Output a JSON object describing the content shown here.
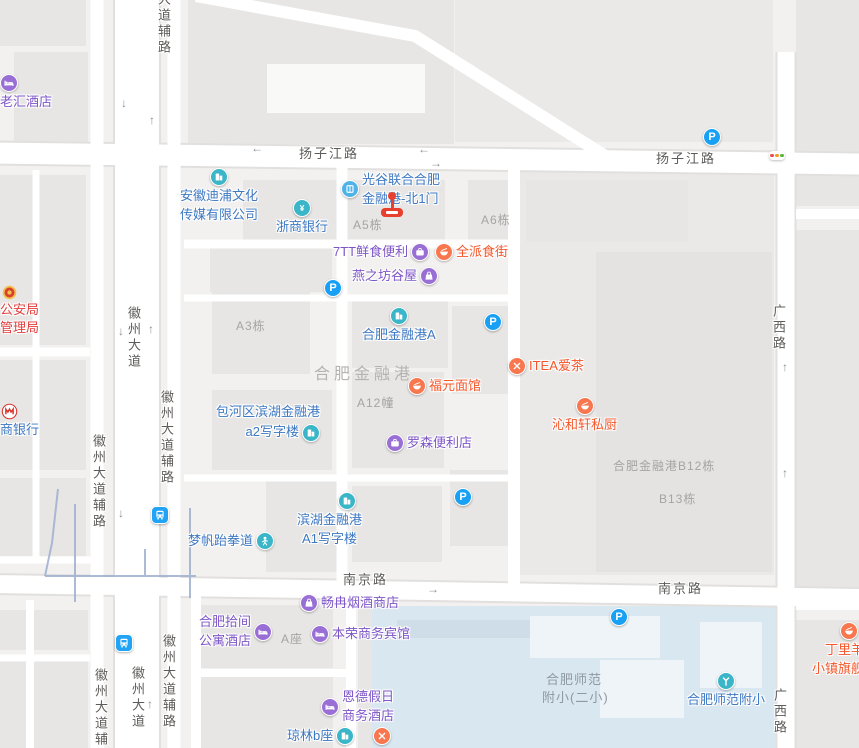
{
  "colors": {
    "purple": "#7d55c7",
    "purpleIcon": "#996fd6",
    "blue": "#3d78c2",
    "teal": "#3ab6c8",
    "gateBlue": "#4fb2e8",
    "orange": "#f4562a",
    "orangeIcon": "#f8774e",
    "red": "#e23d3d",
    "parking": "#18a0f4",
    "busblue": "#22a4f6",
    "grayLbl": "#a6a4a2",
    "roadText": "#5d5c5a",
    "markerRed": "#e8402e"
  },
  "road_labels": [
    {
      "text": "扬子江路"
    },
    {
      "text": "扬子江路"
    },
    {
      "text": "南京路"
    },
    {
      "text": "南京路"
    },
    {
      "text": "徽州大道"
    },
    {
      "text": "大道辅路"
    },
    {
      "text": "徽州大道辅路"
    },
    {
      "text": "徽州大道辅路"
    },
    {
      "text": "徽州大道"
    },
    {
      "text": "徽州大道辅路"
    },
    {
      "text": "徽州大道辅路"
    },
    {
      "text": "广西路"
    },
    {
      "text": "广西路"
    }
  ],
  "building_labels": [
    {
      "text": "A5栋"
    },
    {
      "text": "A6栋"
    },
    {
      "text": "A3栋"
    },
    {
      "text": "A12幢"
    },
    {
      "text": "A座"
    },
    {
      "text": "合肥金融港B12栋"
    },
    {
      "text": "B13栋"
    },
    {
      "text": "合肥金融港"
    },
    {
      "line1": "合肥师范",
      "line2": "附小(二小)"
    }
  ],
  "pois": [
    {
      "name": "老汇酒店"
    },
    {
      "line1": "安徽迪浦文化",
      "line2": "传媒有限公司"
    },
    {
      "name": "浙商银行"
    },
    {
      "line1": "光谷联合合肥",
      "line2": "金融港-北1门"
    },
    {
      "name": "7TT鲜食便利"
    },
    {
      "name": "全派食街"
    },
    {
      "name": "燕之坊谷屋"
    },
    {
      "name": "合肥金融港A"
    },
    {
      "name": "福元面馆"
    },
    {
      "name": "ITEA爱茶"
    },
    {
      "name": "沁和轩私厨"
    },
    {
      "line1": "包河区滨湖金融港",
      "line2": "a2写字楼"
    },
    {
      "name": "罗森便利店"
    },
    {
      "line1": "滨湖金融港",
      "line2": "A1写字楼"
    },
    {
      "name": "梦帆跆拳道"
    },
    {
      "name": "畅冉烟酒商店"
    },
    {
      "line1": "合肥拾间",
      "line2": "公寓酒店"
    },
    {
      "name": "本荣商务宾馆"
    },
    {
      "line1": "恩德假日",
      "line2": "商务酒店"
    },
    {
      "name": "琼林b座"
    },
    {
      "line1": "丁里羊",
      "line2": "小镇旗舰"
    },
    {
      "name": "合肥师范附小"
    },
    {
      "line1": "公安局",
      "line2": "管理局"
    },
    {
      "name": "商银行"
    }
  ],
  "icons": {
    "parking_letter": "P"
  },
  "arrows": [
    "↓",
    "↑",
    "←",
    "←",
    "→",
    "↓",
    "↑",
    "↓",
    "↑",
    "→",
    "↑",
    "↑"
  ]
}
